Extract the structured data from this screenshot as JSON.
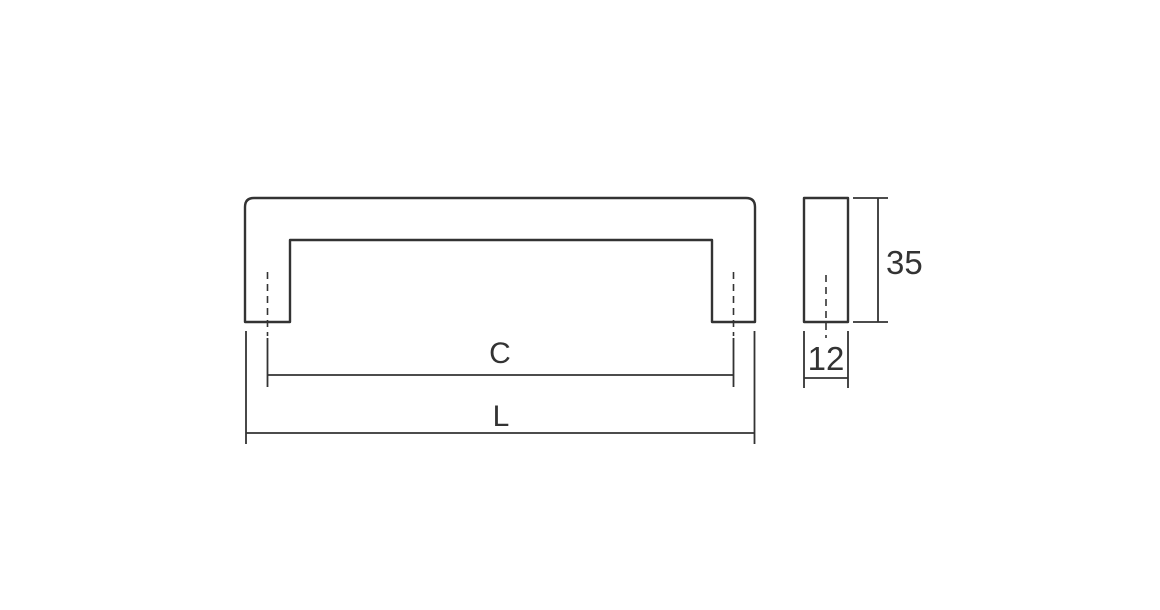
{
  "colors": {
    "line": "#333333",
    "background": "#ffffff"
  },
  "front_view": {
    "dim_c_label": "C",
    "dim_l_label": "L"
  },
  "side_view": {
    "dim_height_label": "35",
    "dim_width_label": "12"
  }
}
